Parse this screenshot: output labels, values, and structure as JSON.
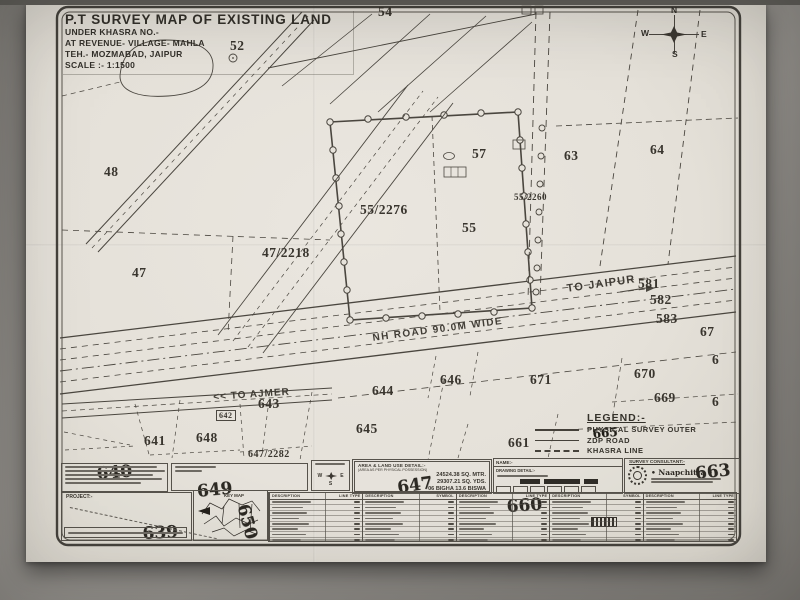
{
  "title_block": {
    "lines": [
      "P.T SURVEY MAP OF EXISTING LAND",
      "UNDER KHASRA NO.-",
      "AT REVENUE- VILLAGE- MAHLA",
      "TEH.- MOZMABAD, JAIPUR",
      "SCALE :- 1:1500"
    ]
  },
  "compass": {
    "n": "N",
    "s": "S",
    "e": "E",
    "w": "W"
  },
  "compass_mini": {
    "w": "W",
    "e": "E",
    "s": "S"
  },
  "roads": {
    "nh_road": "NH ROAD 90.0M WIDE",
    "to_jaipur": "TO JAIPUR →",
    "to_ajmer": "<< TO AJMER"
  },
  "legend": {
    "title": "LEGEND:-",
    "items": [
      {
        "label": "PHYSICAL SURVEY OUTER",
        "style": "solid"
      },
      {
        "label": "ZDP ROAD",
        "style": "thin"
      },
      {
        "label": "KHASRA LINE",
        "style": "dashed"
      }
    ]
  },
  "khasra_labels": [
    {
      "t": "54",
      "x": 378,
      "y": 4
    },
    {
      "t": "52",
      "x": 230,
      "y": 38
    },
    {
      "t": "48",
      "x": 104,
      "y": 164
    },
    {
      "t": "47",
      "x": 132,
      "y": 265
    },
    {
      "t": "47/2218",
      "x": 262,
      "y": 245
    },
    {
      "t": "55/2276",
      "x": 360,
      "y": 202
    },
    {
      "t": "55",
      "x": 462,
      "y": 220
    },
    {
      "t": "57",
      "x": 472,
      "y": 146
    },
    {
      "t": "55/2260",
      "x": 514,
      "y": 192,
      "s": 9
    },
    {
      "t": "63",
      "x": 564,
      "y": 148
    },
    {
      "t": "64",
      "x": 650,
      "y": 142
    },
    {
      "t": "581",
      "x": 638,
      "y": 276
    },
    {
      "t": "582",
      "x": 650,
      "y": 292
    },
    {
      "t": "583",
      "x": 656,
      "y": 311
    },
    {
      "t": "67",
      "x": 700,
      "y": 324
    },
    {
      "t": "6",
      "x": 712,
      "y": 352
    },
    {
      "t": "6",
      "x": 712,
      "y": 394
    },
    {
      "t": "646",
      "x": 440,
      "y": 372
    },
    {
      "t": "671",
      "x": 530,
      "y": 372
    },
    {
      "t": "670",
      "x": 634,
      "y": 366
    },
    {
      "t": "669",
      "x": 654,
      "y": 390
    },
    {
      "t": "644",
      "x": 372,
      "y": 383
    },
    {
      "t": "643",
      "x": 258,
      "y": 396
    },
    {
      "t": "642",
      "x": 216,
      "y": 410,
      "b": true
    },
    {
      "t": "641",
      "x": 144,
      "y": 433
    },
    {
      "t": "648",
      "x": 196,
      "y": 430
    },
    {
      "t": "645",
      "x": 356,
      "y": 421
    },
    {
      "t": "661",
      "x": 508,
      "y": 435
    },
    {
      "t": "647/2282",
      "x": 248,
      "y": 449,
      "s": 10
    }
  ],
  "handwritten": [
    {
      "t": "640",
      "x": 96,
      "y": 464,
      "r": -4
    },
    {
      "t": "639",
      "x": 142,
      "y": 524,
      "r": -3
    },
    {
      "t": "649",
      "x": 196,
      "y": 482,
      "r": -6
    },
    {
      "t": "650",
      "x": 252,
      "y": 502,
      "r": 75
    },
    {
      "t": "647",
      "x": 396,
      "y": 478,
      "r": -8
    },
    {
      "t": "660",
      "x": 506,
      "y": 497,
      "r": -4
    },
    {
      "t": "663",
      "x": 694,
      "y": 464,
      "r": -6
    },
    {
      "t": "665",
      "x": 592,
      "y": 427,
      "r": -5,
      "s": 12
    }
  ],
  "area_detail": {
    "title": "AREA & LAND USE DETAIL:-",
    "subtitle": "(AREA AS PER PHYSICAL POSSESSION)",
    "values": [
      "24524.38 SQ. MTR.",
      "29307.21 SQ. YDS.",
      "06 BIGHA 13.6 BISWA"
    ]
  },
  "boxes": {
    "project_label": "PROJECT:-",
    "key_map_label": "KEY MAP",
    "name_label": "NAME:-",
    "drawing_label": "DRAWING DETAIL:-"
  },
  "consultant": {
    "title": "SURVEY CONSULTANT:-",
    "brand": "• Naapchitra •"
  },
  "tables": {
    "sections": [
      {
        "headers": [
          "DESCRIPTION",
          "LINE TYPE"
        ],
        "rows": 9
      },
      {
        "headers": [
          "DESCRIPTION",
          "SYMBOL"
        ],
        "rows": 9
      },
      {
        "headers": [
          "DESCRIPTION",
          "LINE TYPE"
        ],
        "rows": 9
      },
      {
        "headers": [
          "DESCRIPTION",
          "SYMBOL"
        ],
        "rows": 9
      },
      {
        "headers": [
          "DESCRIPTION",
          "LINE TYPE"
        ],
        "rows": 9
      }
    ]
  },
  "colors": {
    "paper": "#e6e2da",
    "ink": "#45413a",
    "pen": "#1f1c16"
  }
}
